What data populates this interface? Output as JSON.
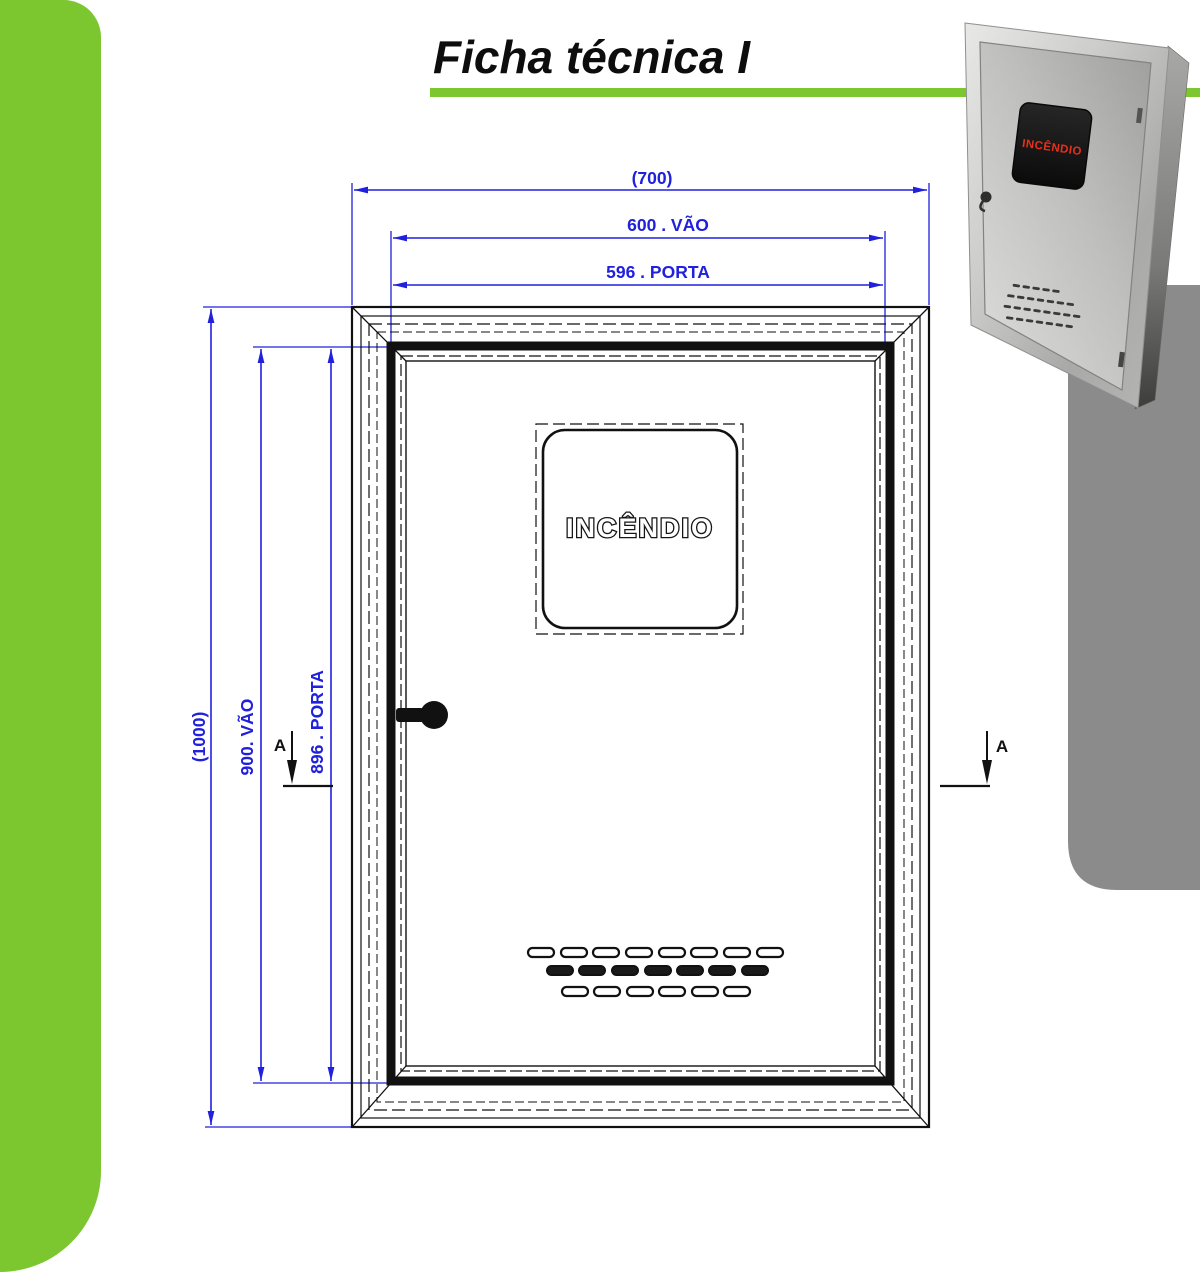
{
  "header": {
    "title": "Ficha técnica I"
  },
  "drawing": {
    "dim_overall_width": "(700)",
    "dim_vao_width": "600 . VÃO",
    "dim_porta_width": "596 . PORTA",
    "dim_overall_height": "(1000)",
    "dim_vao_height": "900. VÃO",
    "dim_porta_height": "896 . PORTA",
    "section_left": "A",
    "section_right": "A",
    "door_label": "INCÊNDIO"
  },
  "photo": {
    "label": "INCÊNDIO"
  },
  "colors": {
    "accent_green": "#7cc62f",
    "dimension_blue": "#2020dd",
    "label_red": "#e8301c",
    "backdrop_gray": "#8b8b8b"
  }
}
